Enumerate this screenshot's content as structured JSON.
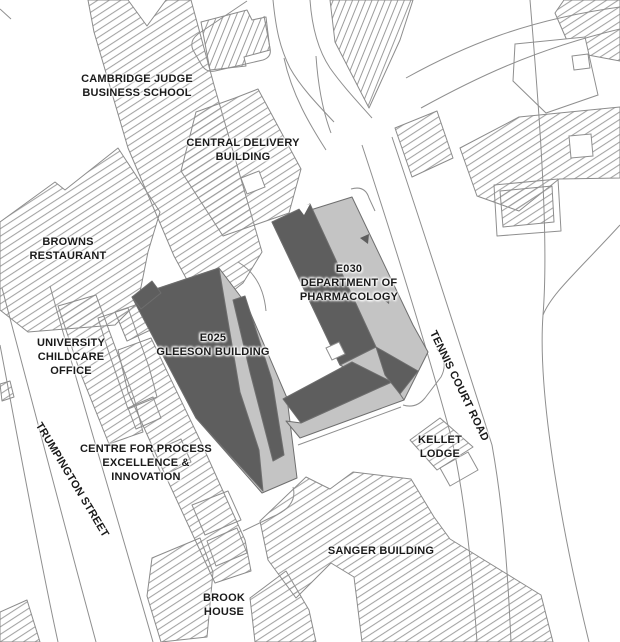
{
  "map": {
    "labels": {
      "cambridge_judge_business_school": "CAMBRIDGE JUDGE\nBUSINESS SCHOOL",
      "central_delivery_building": "CENTRAL DELIVERY\nBUILDING",
      "browns_restaurant": "BROWNS\nRESTAURANT",
      "e030_department_of_pharmacology": "E030\nDEPARTMENT OF\nPHARMACOLOGY",
      "e025_gleeson_building": "E025\nGLEESON BUILDING",
      "university_childcare_office": "UNIVERSITY\nCHILDCARE\nOFFICE",
      "centre_for_process_excellence_innovation": "CENTRE FOR PROCESS\nEXCELLENCE &\nINNOVATION",
      "trumpington_street": "TRUMPINGTON STREET",
      "tennis_court_road": "TENNIS COURT ROAD",
      "kellet_lodge": "KELLET\nLODGE",
      "sanger_building": "SANGER BUILDING",
      "brook_house": "BROOK\nHOUSE"
    },
    "highlighted_buildings": [
      {
        "code": "E025",
        "name": "GLEESON BUILDING"
      },
      {
        "code": "E030",
        "name": "DEPARTMENT OF PHARMACOLOGY"
      }
    ],
    "colors": {
      "background": "#ffffff",
      "roof_dark": "#5e5e5e",
      "roof_light": "#c4c4c4",
      "hatch_line": "#9c9c9c",
      "outline": "#8c8c8c",
      "label_text": "#1a1a1a"
    }
  }
}
